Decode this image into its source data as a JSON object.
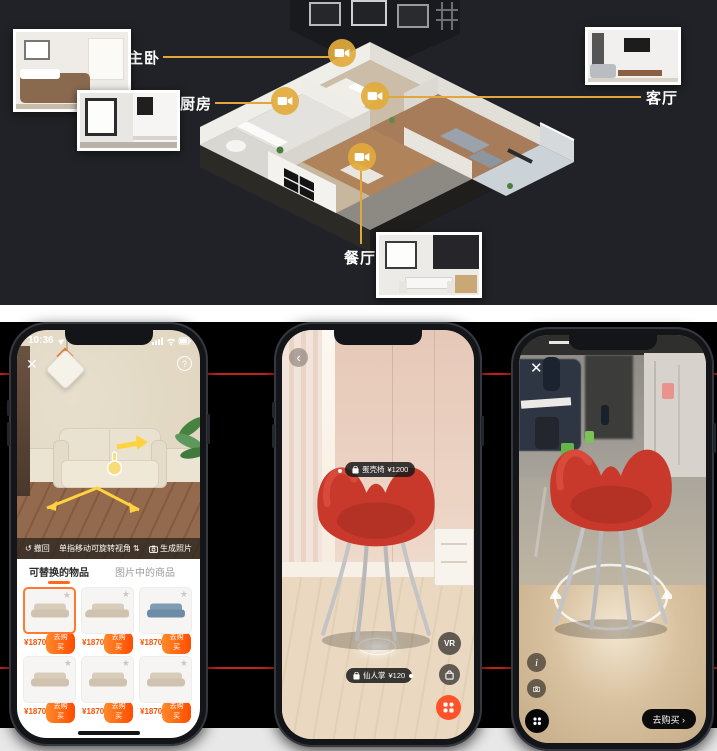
{
  "top_section": {
    "rooms": [
      {
        "name": "master-bedroom",
        "label": "主卧"
      },
      {
        "name": "kitchen",
        "label": "厨房"
      },
      {
        "name": "living-room",
        "label": "客厅"
      },
      {
        "name": "dining-room",
        "label": "餐厅"
      }
    ]
  },
  "left_phone": {
    "status": {
      "time": "10:36"
    },
    "close_glyph": "✕",
    "help_glyph": "?",
    "toolbar": {
      "undo_label": "撤回",
      "hint_label": "单指移动可旋转视角",
      "generate_label": "生成照片"
    },
    "tabs": [
      {
        "label": "可替换的物品",
        "active": true
      },
      {
        "label": "图片中的商品",
        "active": false
      }
    ],
    "buy_label": "去购买",
    "products": [
      {
        "price": "¥1870"
      },
      {
        "price": "¥1870"
      },
      {
        "price": "¥1870"
      },
      {
        "price": "¥1870"
      },
      {
        "price": "¥1870"
      },
      {
        "price": "¥1870"
      }
    ]
  },
  "middle_phone": {
    "back_glyph": "‹",
    "item_tag": {
      "name": "蛋壳椅",
      "price": "¥1200"
    },
    "floor_tag": {
      "name": "仙人掌",
      "price": "¥120"
    },
    "vr_label": "VR"
  },
  "right_phone": {
    "close_glyph": "✕",
    "info_glyph": "i",
    "buy_label": "去购买 ›"
  },
  "icons": {
    "star": "★",
    "undo": "↺",
    "rotate": "⇅"
  },
  "colors": {
    "accent_orange": "#E2AA3C",
    "price_orange": "#FF5000",
    "buy_gradient_start": "#FF8A2B",
    "buy_gradient_end": "#FF4D00",
    "red_line": "#E8281E",
    "chair_red": "#C8392B",
    "tab_underline": "#FF6A1A",
    "cta_black": "#0B0B0B",
    "orange_fab": "#FF5228",
    "sofa_beige": "#D8CDBB",
    "sofa_blue": "#7F9CB5"
  }
}
